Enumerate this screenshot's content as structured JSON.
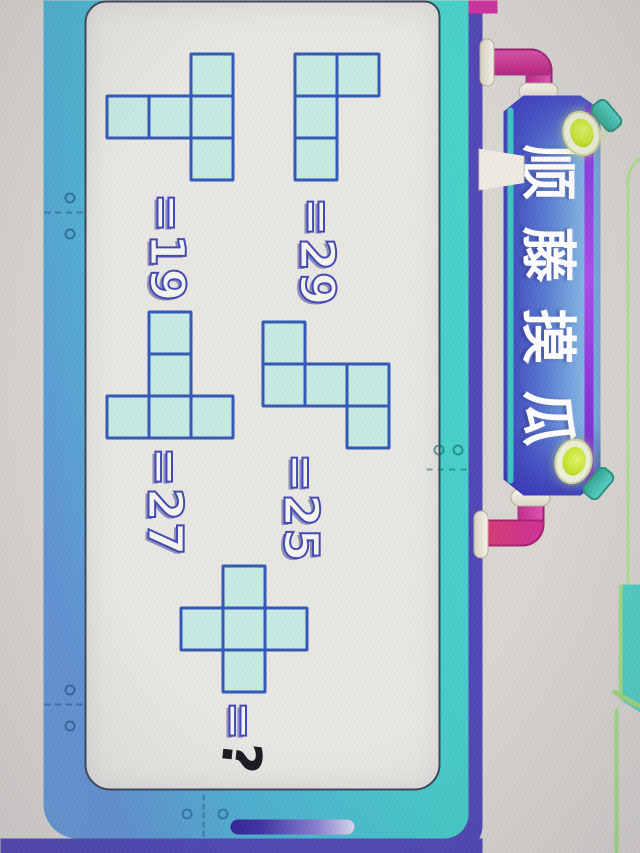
{
  "banner": {
    "title": "顺藤摸瓜"
  },
  "puzzle": {
    "equals_sign": "=",
    "shapes": [
      {
        "name": "l-tetromino",
        "value": "29",
        "cells": [
          [
            0,
            0
          ],
          [
            1,
            0
          ],
          [
            1,
            1
          ],
          [
            1,
            2
          ]
        ]
      },
      {
        "name": "s-pentomino",
        "value": "25",
        "cells": [
          [
            0,
            1
          ],
          [
            0,
            2
          ],
          [
            1,
            1
          ],
          [
            2,
            0
          ],
          [
            2,
            1
          ]
        ]
      },
      {
        "name": "t-pentomino-down",
        "value": "19",
        "cells": [
          [
            0,
            0
          ],
          [
            0,
            1
          ],
          [
            0,
            2
          ],
          [
            1,
            1
          ],
          [
            2,
            1
          ]
        ]
      },
      {
        "name": "t-pentomino-left",
        "value": "27",
        "cells": [
          [
            0,
            2
          ],
          [
            1,
            0
          ],
          [
            1,
            1
          ],
          [
            1,
            2
          ],
          [
            2,
            2
          ]
        ]
      },
      {
        "name": "plus-pentomino",
        "value": "?",
        "cells": [
          [
            0,
            1
          ],
          [
            1,
            0
          ],
          [
            1,
            1
          ],
          [
            1,
            2
          ],
          [
            2,
            1
          ]
        ]
      }
    ]
  },
  "theme": {
    "cell_fill": "#c6eae2",
    "cell_border": "#2e55b5",
    "frame_teal": "#43d2c8",
    "frame_blue": "#5f92d4",
    "edge_indigo": "#4e44b4",
    "pipe_magenta": "#cf2f9c",
    "banner_violet": "#9a30dd",
    "lamp_green": "#c8e62e"
  }
}
